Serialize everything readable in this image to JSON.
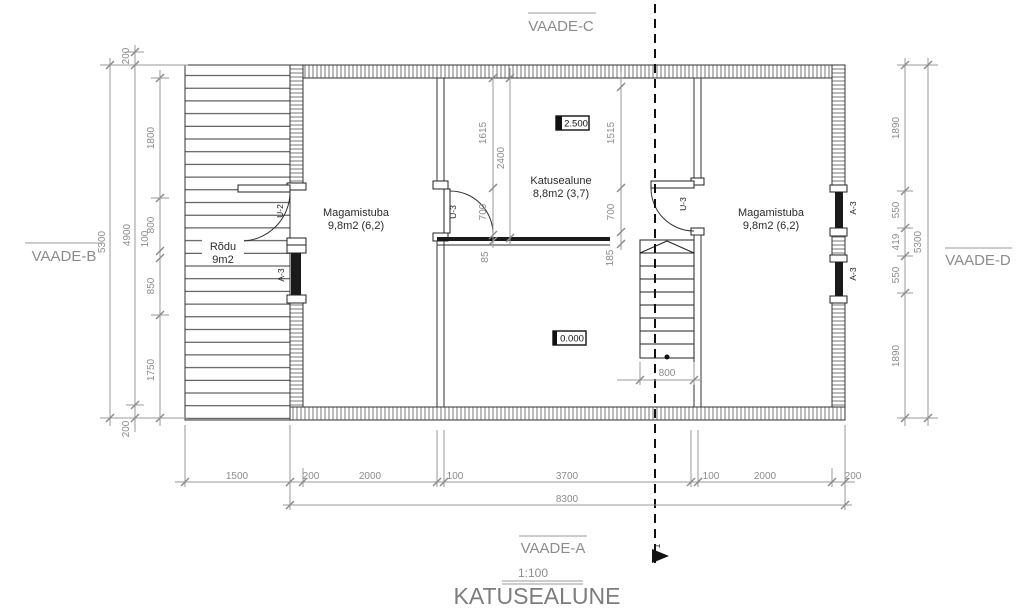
{
  "drawing_title": {
    "name": "KATUSEALUNE",
    "scale": "1:100"
  },
  "view_labels": {
    "top": "VAADE-C",
    "left": "VAADE-B",
    "right": "VAADE-D",
    "bottom": "VAADE-A"
  },
  "section_marker": "1",
  "rooms": {
    "balcony": {
      "name": "Rõdu",
      "area": "9m2"
    },
    "bedroom_left": {
      "name": "Magamistuba",
      "area": "9,8m2 (6,2)"
    },
    "attic_center": {
      "name": "Katusealune",
      "area": "8,8m2 (3,7)"
    },
    "bedroom_right": {
      "name": "Magamistuba",
      "area": "9,8m2 (6,2)"
    }
  },
  "levels": {
    "upper": "2.500",
    "main": "0.000"
  },
  "doors": {
    "u2": "U-2",
    "u3_left": "U-3",
    "u3_right": "U-3"
  },
  "windows": {
    "left": "A-3",
    "right_top": "A-3",
    "right_bottom": "A-3"
  },
  "dimensions": {
    "left": {
      "total": "5300",
      "outer_top": "200",
      "outer_mid": "4900",
      "outer_bottom": "200",
      "inner": [
        "1800",
        "800",
        "100",
        "850",
        "1750"
      ]
    },
    "right": {
      "total": "5300",
      "chain": [
        "1890",
        "550",
        "419",
        "550",
        "1890"
      ]
    },
    "bottom": {
      "chain": [
        "1500",
        "200",
        "2000",
        "100",
        "3700",
        "100",
        "2000",
        "200"
      ],
      "total": "8300"
    },
    "interior": {
      "c1": [
        "1615",
        "700",
        "85"
      ],
      "c2": "2400",
      "c3": [
        "1515",
        "700",
        "185"
      ],
      "stair_width": "800"
    }
  },
  "colors": {
    "line": "#333333",
    "dim": "#8c8c8c",
    "gray_label": "#7d7d7d",
    "dark": "#1a1a1a"
  }
}
